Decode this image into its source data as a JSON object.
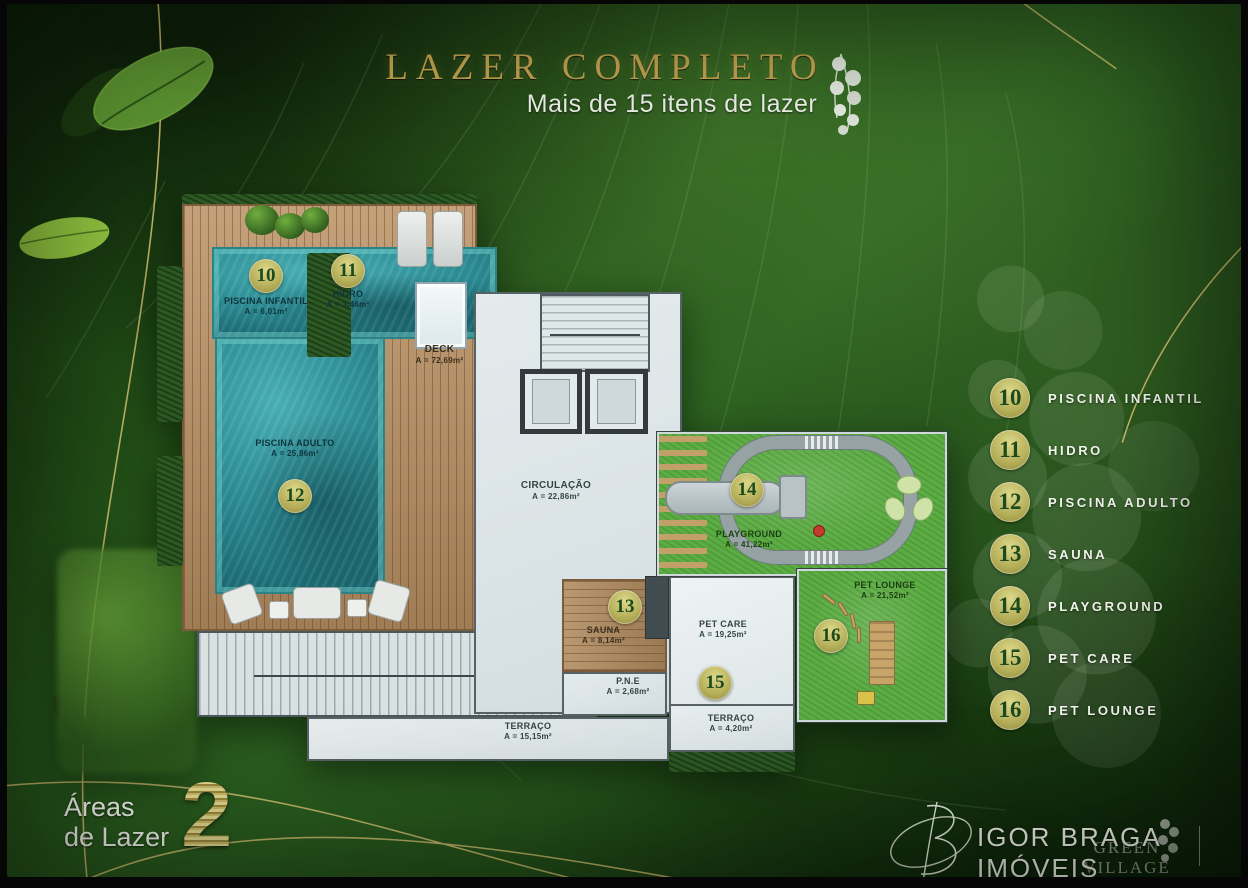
{
  "header": {
    "title": "LAZER COMPLETO",
    "subtitle": "Mais de 15 itens de lazer"
  },
  "legend": {
    "items": [
      {
        "num": "10",
        "label": "PISCINA INFANTIL"
      },
      {
        "num": "11",
        "label": "HIDRO"
      },
      {
        "num": "12",
        "label": "PISCINA ADULTO"
      },
      {
        "num": "13",
        "label": "SAUNA"
      },
      {
        "num": "14",
        "label": "PLAYGROUND"
      },
      {
        "num": "15",
        "label": "PET CARE"
      },
      {
        "num": "16",
        "label": "PET LOUNGE"
      }
    ]
  },
  "plan": {
    "rooms": [
      {
        "name": "PISCINA INFANTIL",
        "area": "A = 6,01m²"
      },
      {
        "name": "HIDRO",
        "area": "A = 3,46m²"
      },
      {
        "name": "DECK",
        "area": "A = 72,69m²"
      },
      {
        "name": "PISCINA ADULTO",
        "area": "A = 25,86m²"
      },
      {
        "name": "CIRCULAÇÃO",
        "area": "A = 22,86m²"
      },
      {
        "name": "SAUNA",
        "area": "A = 8,14m²"
      },
      {
        "name": "PET CARE",
        "area": "A = 19,25m²"
      },
      {
        "name": "P.N.E",
        "area": "A = 2,68m²"
      },
      {
        "name": "TERRAÇO",
        "area": "A = 15,15m²"
      },
      {
        "name": "TERRAÇO",
        "area": "A = 4,20m²"
      },
      {
        "name": "PLAYGROUND",
        "area": "A = 41,22m²"
      },
      {
        "name": "PET LOUNGE",
        "area": "A = 21,52m²"
      }
    ],
    "badges": [
      "10",
      "11",
      "12",
      "13",
      "14",
      "15",
      "16"
    ]
  },
  "footer": {
    "areas_line1": "Áreas",
    "areas_line2": "de Lazer",
    "areas_number": "2",
    "brand": "IGOR BRAGA IMÓVEIS",
    "watermark_title": "GREEN VILLAGE",
    "watermark_subtitle": "RESIDENCE"
  },
  "icons": {
    "header_icon": "eucalyptus-sprig-icon",
    "brand_icon": "signature-b-icon",
    "watermark_icon": "eucalyptus-cluster-icon"
  },
  "colors": {
    "gold_accent": "#c9ab52",
    "background_green": "#24501a",
    "water_teal": "#2b8b93",
    "deck_wood": "#bb9164",
    "grass_green": "#5cad43",
    "badge_gold": "#b3ac57",
    "badge_number_green": "#1c4a1c",
    "text_white": "#f1f5ec"
  }
}
